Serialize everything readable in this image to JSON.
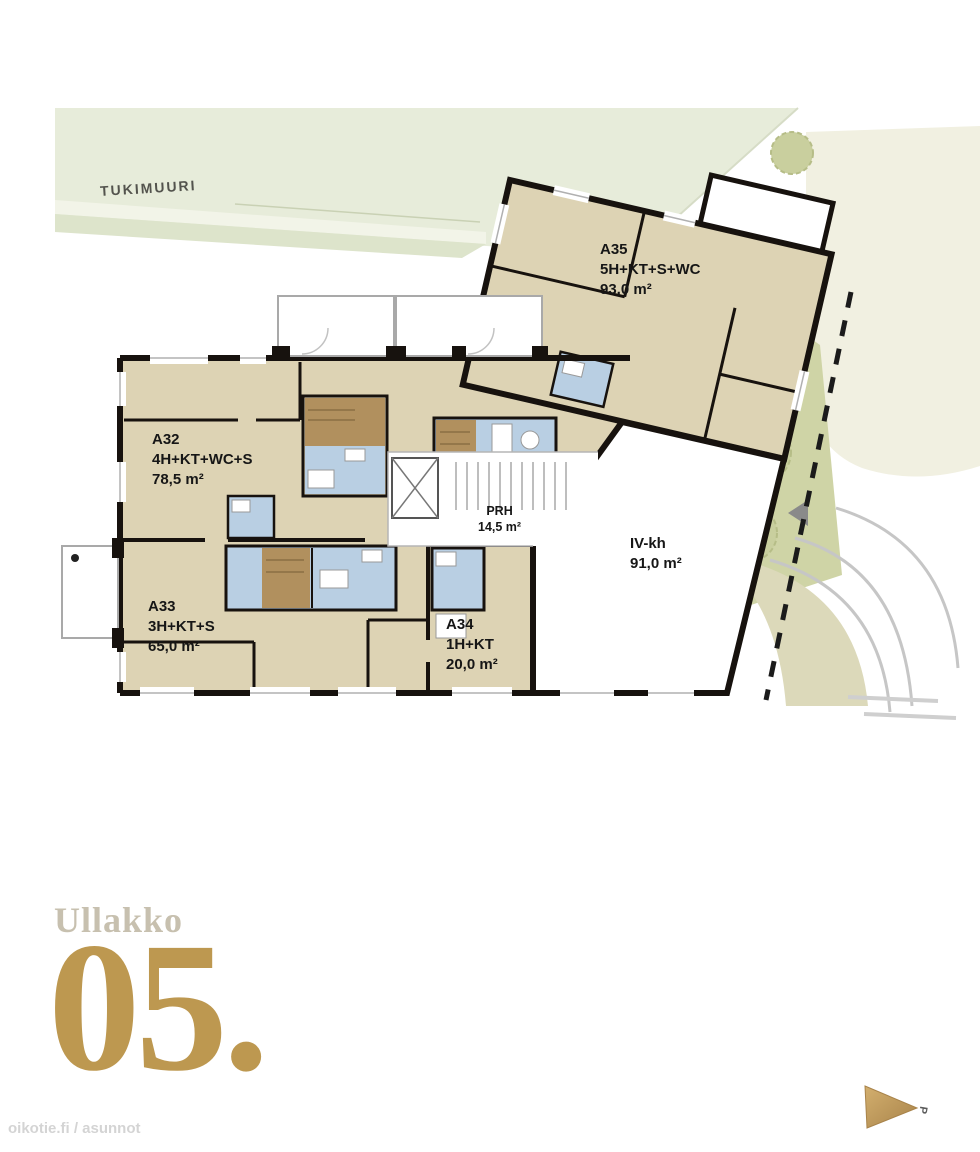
{
  "site": {
    "retaining_wall_label": "TUKIMUURI"
  },
  "apartments": {
    "a32": {
      "id": "A32",
      "rooms": "4H+KT+WC+S",
      "area": "78,5 m²"
    },
    "a33": {
      "id": "A33",
      "rooms": "3H+KT+S",
      "area": "65,0 m²"
    },
    "a34": {
      "id": "A34",
      "rooms": "1H+KT",
      "area": "20,0 m²"
    },
    "a35": {
      "id": "A35",
      "rooms": "5H+KT+S+WC",
      "area": "93,0 m²"
    }
  },
  "common_spaces": {
    "prh": {
      "id": "PRH",
      "area": "14,5 m²"
    },
    "iv_kh": {
      "id": "IV-kh",
      "area": "91,0 m²"
    }
  },
  "floor": {
    "name": "Ullakko",
    "number": "05."
  },
  "compass": {
    "north_label": "P"
  },
  "watermark": "oikotie.fi / asunnot",
  "colors": {
    "apartment_fill": "#ddd3b4",
    "wet_room_fill": "#b9cfe3",
    "sauna_fill": "#b1905e",
    "wall": "#17120e",
    "site_green": "#e7ecda",
    "tree_olive": "#c9cf9e",
    "neighbor_cream": "#f1f0e1",
    "accent_gold": "#bd9850",
    "floor_name_gray": "#c7c0af"
  }
}
